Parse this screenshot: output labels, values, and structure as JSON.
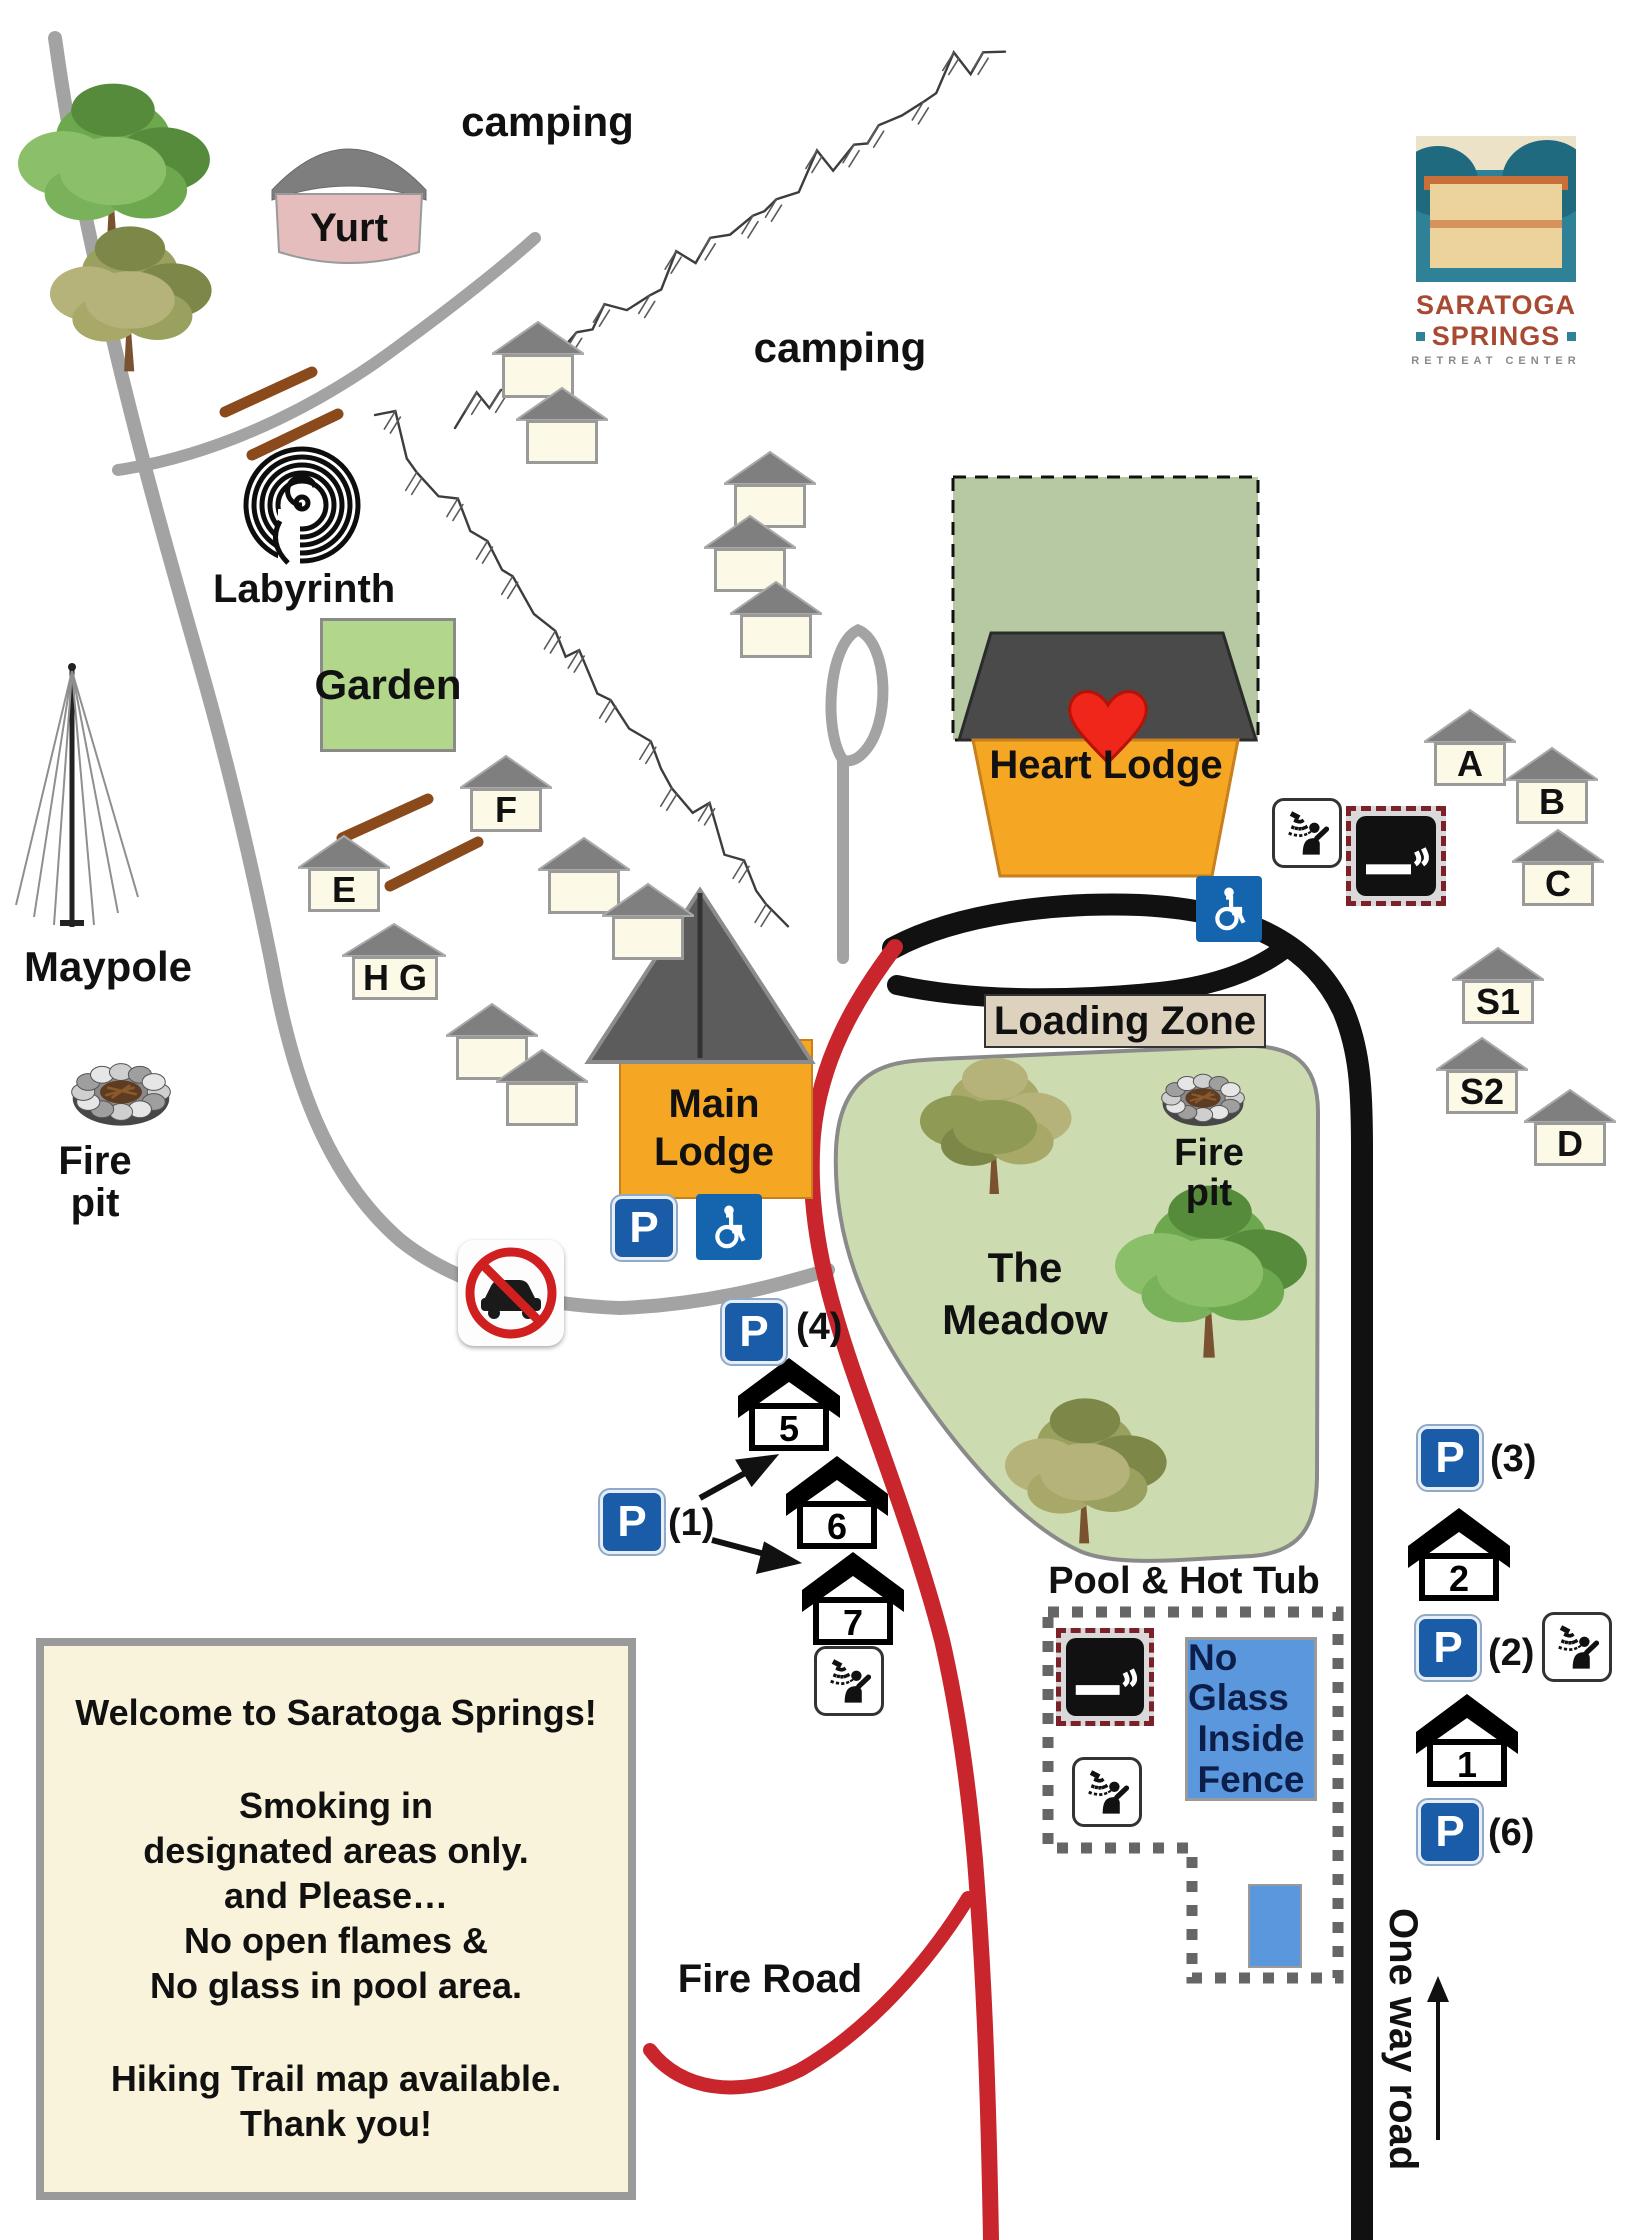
{
  "logo": {
    "line1": "SARATOGA",
    "line2": "SPRINGS",
    "line3": "RETREAT CENTER"
  },
  "labels": {
    "camping_upper": "camping",
    "camping_lower": "camping",
    "yurt": "Yurt",
    "labyrinth": "Labyrinth",
    "garden": "Garden",
    "maypole": "Maypole",
    "fire_pit_west": "Fire pit",
    "fire_pit_meadow": "Fire pit",
    "loading_zone": "Loading Zone",
    "meadow_line1": "The",
    "meadow_line2": "Meadow",
    "main_lodge_line1": "Main",
    "main_lodge_line2": "Lodge",
    "heart_lodge": "Heart Lodge",
    "pool_title": "Pool & Hot Tub",
    "no_glass_line1": "No Glass",
    "no_glass_line2": "Inside",
    "no_glass_line3": "Fence",
    "fire_road": "Fire Road",
    "one_way_road": "One way road"
  },
  "cabins": {
    "f": "F",
    "e": "E",
    "hg": "H G",
    "a": "A",
    "b": "B",
    "c": "C",
    "s1": "S1",
    "s2": "S2",
    "d": "D",
    "n1": "1",
    "n2": "2",
    "n5": "5",
    "n6": "6",
    "n7": "7"
  },
  "parking": {
    "p": "P",
    "count_4": "(4)",
    "count_1": "(1)",
    "count_3": "(3)",
    "count_2": "(2)",
    "count_6": "(6)"
  },
  "welcome": {
    "line1": "Welcome to  Saratoga Springs!",
    "line2": "Smoking in",
    "line3": "designated areas only.",
    "line4": "and Please…",
    "line5": "No open flames &",
    "line6": "No glass in pool area.",
    "line7": "Hiking Trail map available.",
    "line8": "Thank you!"
  },
  "icons": [
    "parking-icon",
    "accessible-icon",
    "shower-icon",
    "smoking-area-icon",
    "no-cars-icon",
    "heart-icon",
    "fire-pit-icon",
    "labyrinth-icon",
    "maypole-icon",
    "tree-icon",
    "one-way-arrow-icon"
  ],
  "colors": {
    "road_red": "#c9252c",
    "road_black": "#111111",
    "road_gray": "#a3a3a3",
    "meadow_green": "#ccdcb0",
    "heart_square_green": "#b7c9a3",
    "garden_green": "#b2d68a",
    "lodge_orange": "#f5a623",
    "yurt_pink": "#e6bdbd",
    "sign_cream": "#f8f3da",
    "parking_blue": "#1b5ca8",
    "pool_blue": "#5b97dd",
    "heart_red": "#f1261b",
    "logo_teal": "#2e8196",
    "logo_rust": "#a84a32",
    "loading_tan": "#dcd2bd"
  }
}
